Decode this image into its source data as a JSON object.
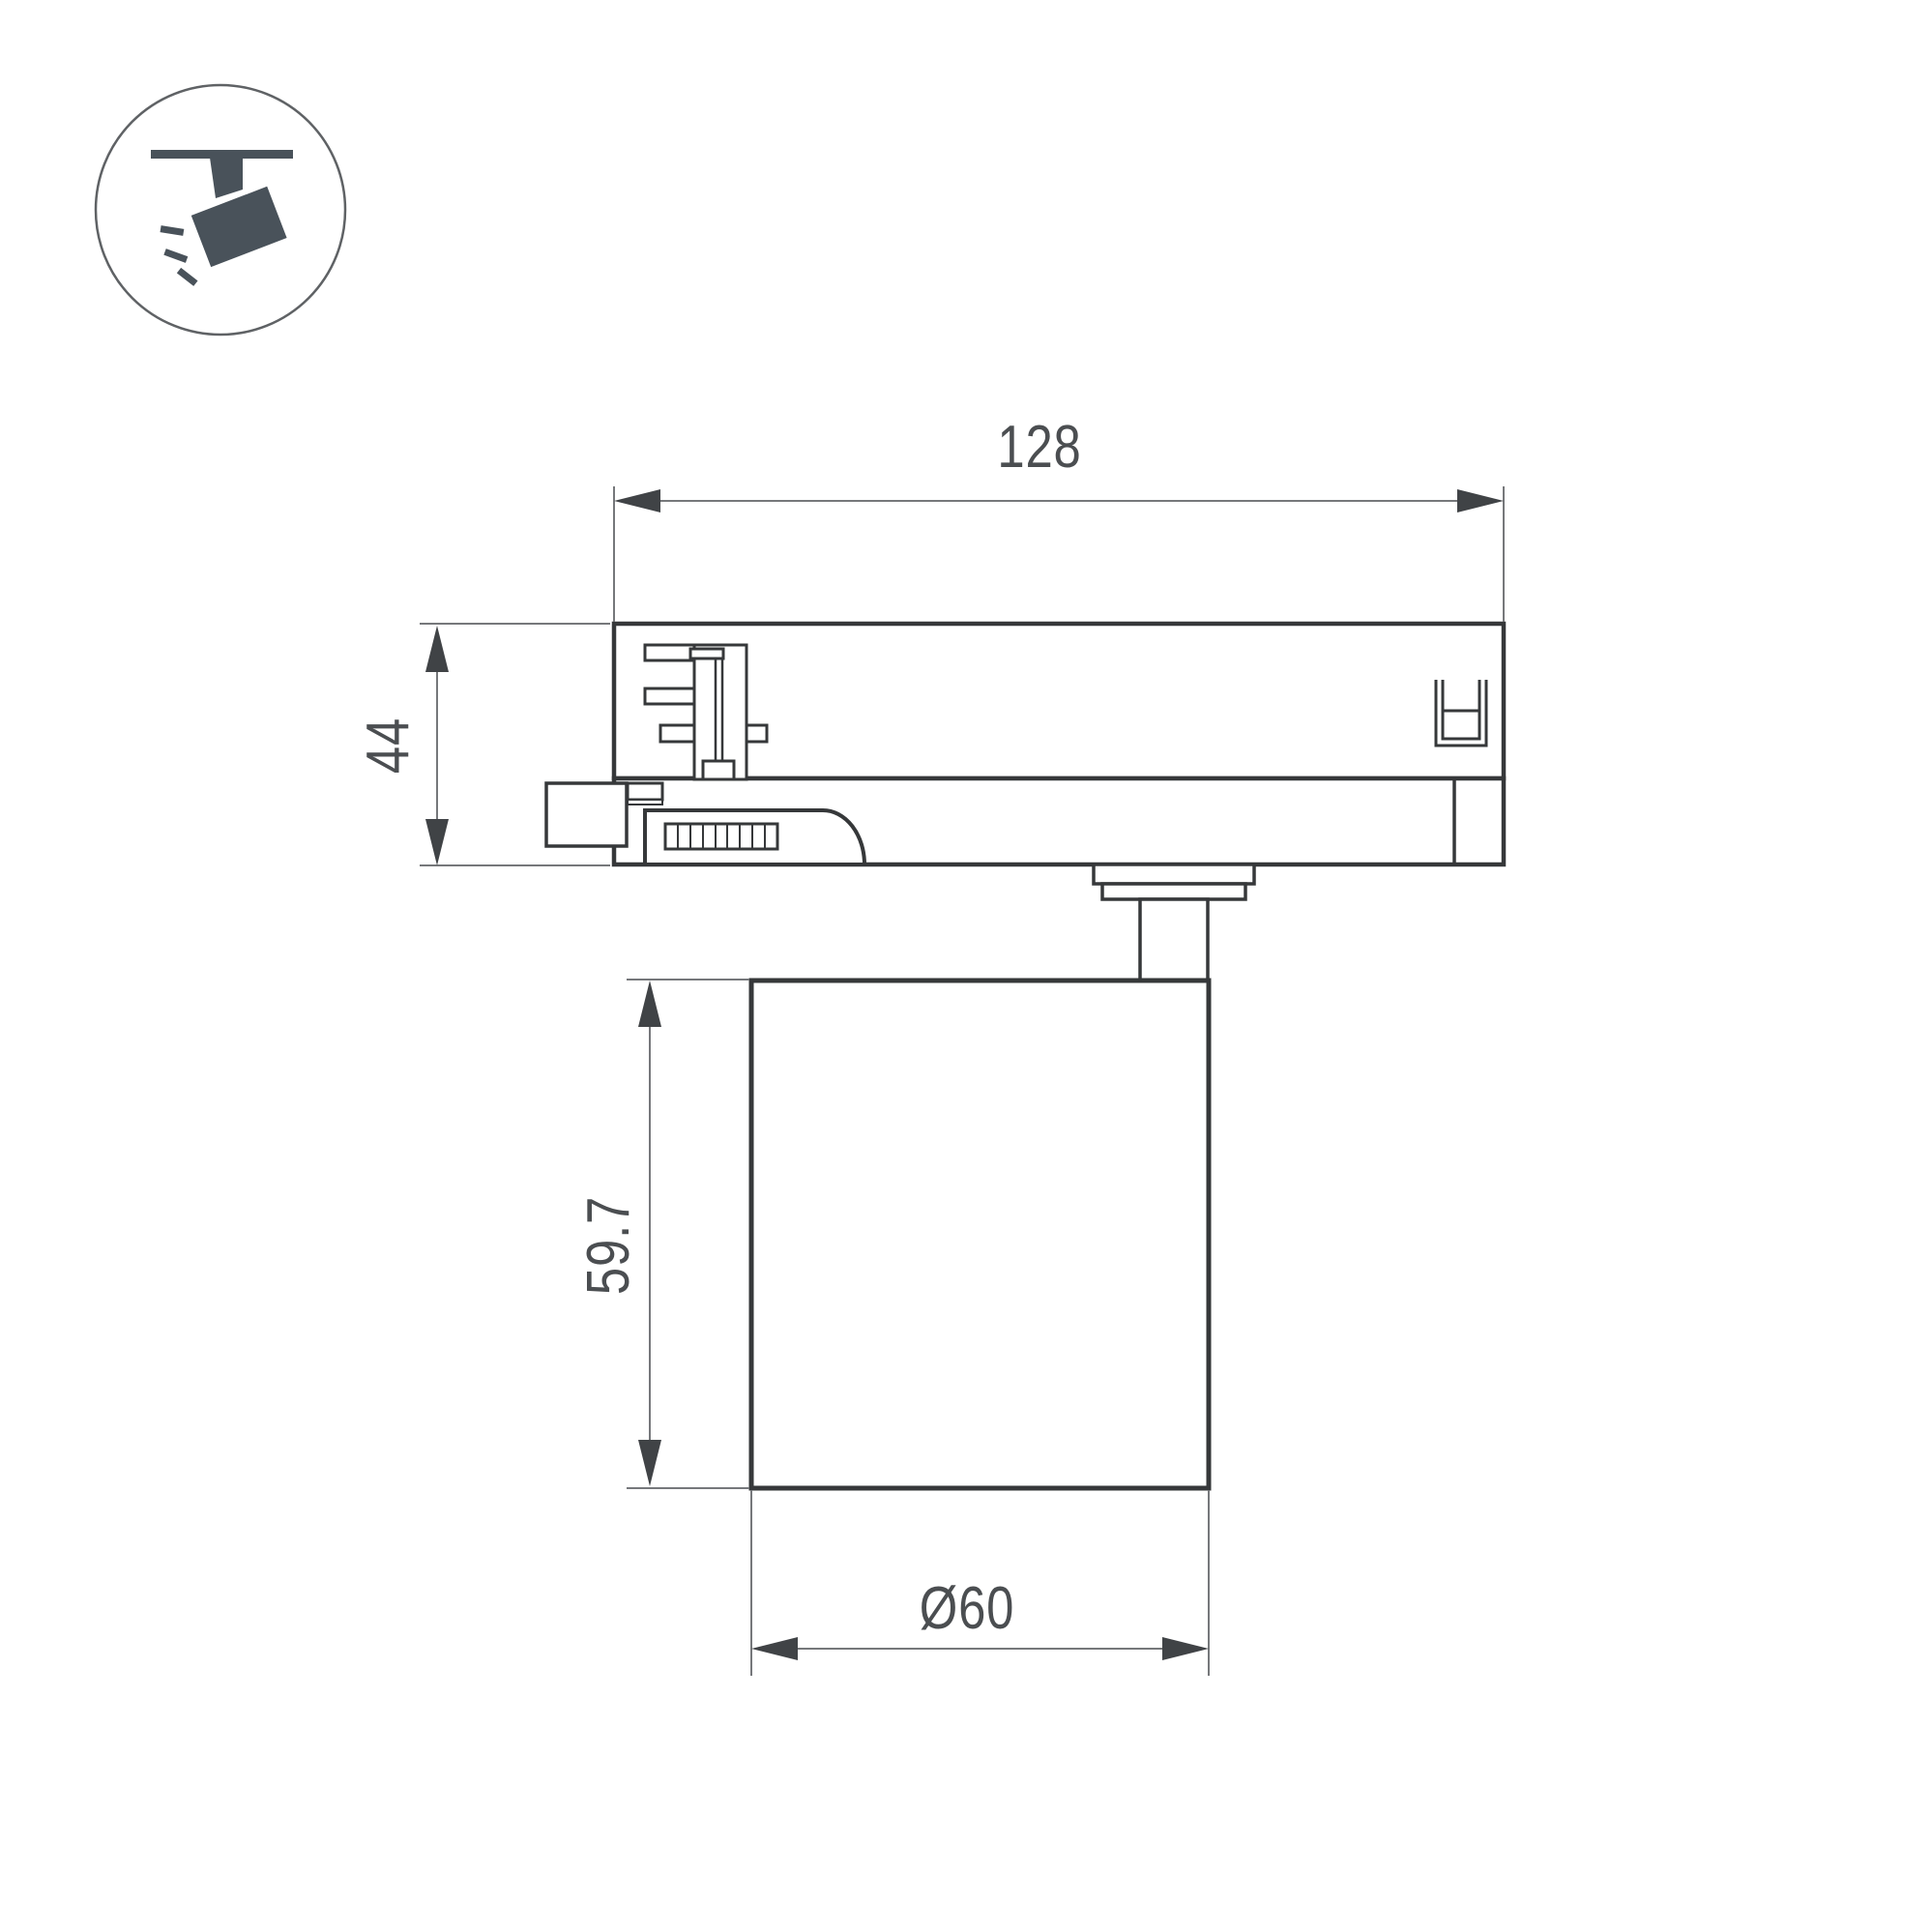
{
  "icon": {
    "name": "track-spotlight-pictogram",
    "fill_color": "#49525a",
    "circle_color": "#5f6265"
  },
  "drawing": {
    "outline_color": "#36383a",
    "dim_line_color": "#76787b",
    "arrow_color": "#404346",
    "label_color": "#4b4e51",
    "dimensions": {
      "track_adapter_length": "128",
      "track_adapter_height": "44",
      "lamp_body_height": "59.7",
      "lamp_body_diameter": "Ø60"
    }
  }
}
